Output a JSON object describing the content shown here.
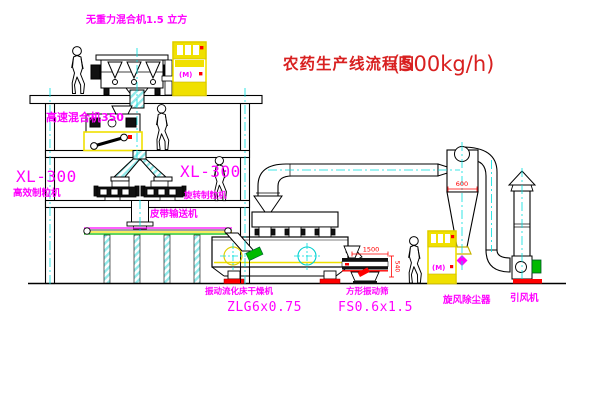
{
  "title": {
    "text": "农药生产线流程图",
    "capacity": "(500kg/h)"
  },
  "equipment_labels": {
    "gravity_mixer": "无重力混合机1.5 立方",
    "high_speed_mixer": "高速混合机350",
    "granulator_left": {
      "model": "XL-300",
      "name": "高效制粒机"
    },
    "granulator_right": {
      "model": "XL-300",
      "name": "旋转制粒机"
    },
    "belt_conveyor": "皮带输送机",
    "fluid_bed_dryer": {
      "name": "振动流化床干燥机",
      "model": "ZLG6x0.75"
    },
    "square_sieve": {
      "name": "方形振动筛",
      "model": "FS0.6x1.5"
    },
    "cyclone": "旋风除尘器",
    "induced_draft_fan": "引风机",
    "elevator_top_mark": "(M)",
    "elevator_right_mark": "(M)"
  },
  "dimensions": {
    "cyclone_width": "600",
    "sieve_length": "1500",
    "sieve_height": "540"
  },
  "colors": {
    "label_magenta": "#FF00FF",
    "title_red": "#D82020",
    "dimension_red": "#FF0000",
    "equipment_yellow": "#F0E000",
    "centerline_cyan": "#00DEDE",
    "green": "#00BB00",
    "line": "#000000",
    "background": "#FFFFFF"
  }
}
